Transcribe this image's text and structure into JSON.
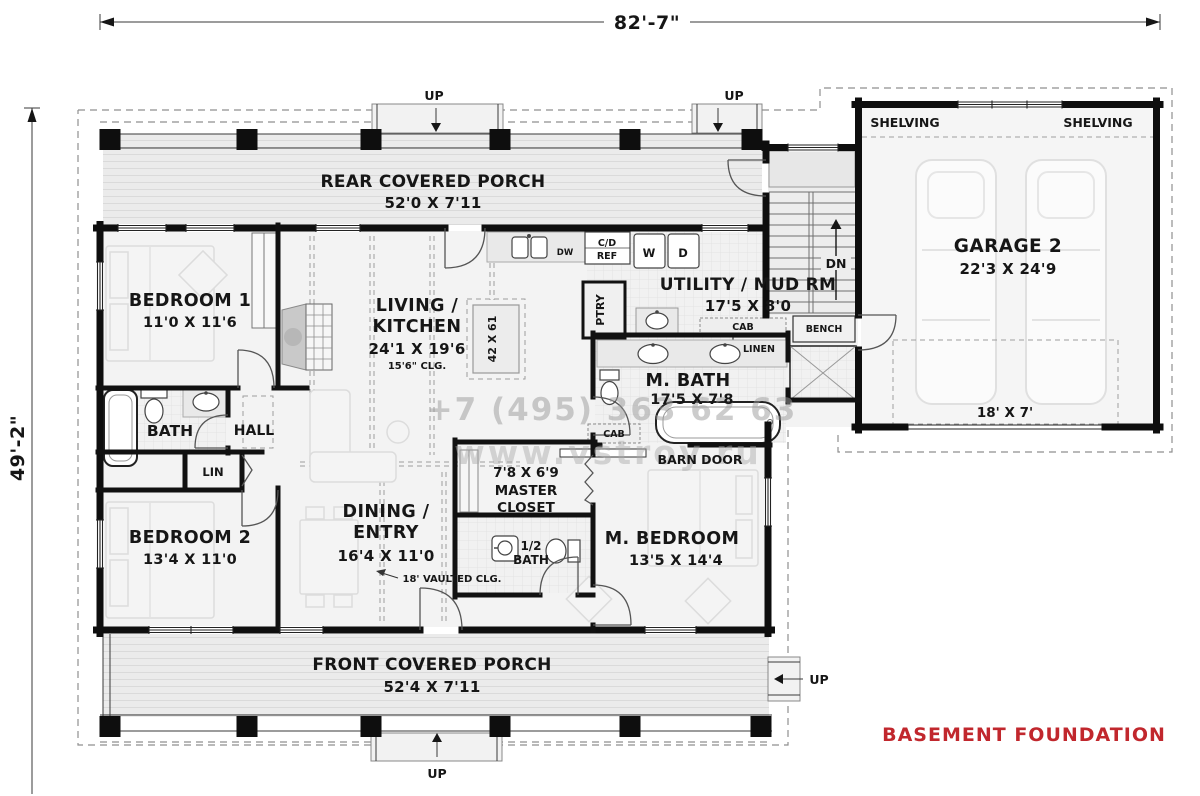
{
  "dimensions": {
    "overall_width": "82'-7\"",
    "overall_height": "49'-2\""
  },
  "foundation": {
    "label": "BASEMENT FOUNDATION",
    "color": "#c1272d"
  },
  "watermark": {
    "phone": "+7 (495) 363 62 63",
    "website": "www.vstroy.ru"
  },
  "stairs": {
    "up": "UP",
    "down": "DN"
  },
  "rooms": {
    "rear_porch": {
      "name": "REAR COVERED PORCH",
      "dims": "52'0 X 7'11"
    },
    "front_porch": {
      "name": "FRONT COVERED PORCH",
      "dims": "52'4 X 7'11"
    },
    "bedroom1": {
      "name": "BEDROOM 1",
      "dims": "11'0 X 11'6"
    },
    "bedroom2": {
      "name": "BEDROOM 2",
      "dims": "13'4 X 11'0"
    },
    "living_kitchen": {
      "name1": "LIVING /",
      "name2": "KITCHEN",
      "dims": "24'1 X 19'6",
      "ceiling": "15'6\" CLG."
    },
    "dining_entry": {
      "name1": "DINING /",
      "name2": "ENTRY",
      "dims": "16'4 X 11'0",
      "ceiling": "18' VAULTED CLG."
    },
    "utility": {
      "name": "UTILITY / MUD RM",
      "dims": "17'5 X 8'0"
    },
    "garage": {
      "name": "GARAGE 2",
      "dims": "22'3 X 24'9",
      "door_size": "18' X 7'",
      "shelving": "SHELVING"
    },
    "master_bath": {
      "name": "M. BATH",
      "dims": "17'5 X 7'8"
    },
    "master_bedroom": {
      "name": "M. BEDROOM",
      "dims": "13'5 X 14'4"
    },
    "master_closet": {
      "dims": "7'8 X 6'9",
      "name1": "MASTER",
      "name2": "CLOSET"
    },
    "half_bath": {
      "name1": "1/2",
      "name2": "BATH"
    },
    "bath": {
      "name": "BATH"
    },
    "hall": {
      "name": "HALL"
    },
    "linen_small": {
      "name": "LIN"
    }
  },
  "fixtures": {
    "island_dims": "42 X 61",
    "pantry": "PTRY",
    "cabinet": "CAB",
    "bench": "BENCH",
    "linen": "LINEN",
    "barn_door": "BARN DOOR",
    "washer": "W",
    "dryer": "D",
    "dishwasher": "DW",
    "ref1": "C/D",
    "ref2": "REF"
  }
}
